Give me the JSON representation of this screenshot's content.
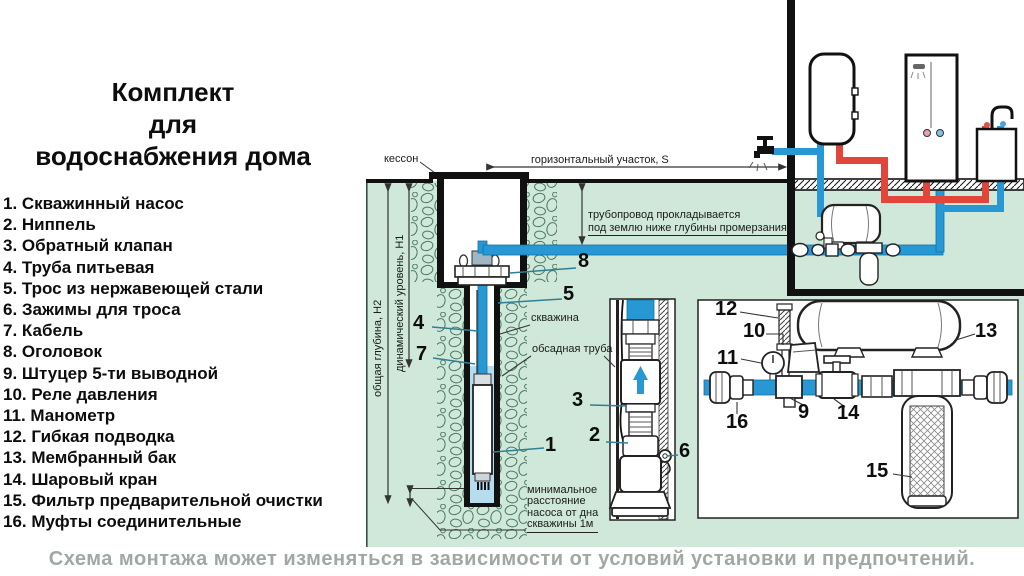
{
  "title": {
    "lines": [
      "Комплект",
      "для",
      "водоснабжения дома"
    ]
  },
  "legend": {
    "items": [
      "1. Скважинный насос",
      "2. Ниппель",
      "3. Обратный клапан",
      "4. Труба питьевая",
      "5. Трос из нержавеющей стали",
      "6. Зажимы для троса",
      "7. Кабель",
      "8. Оголовок",
      "9. Штуцер 5-ти выводной",
      "10. Реле давления",
      "11. Манометр",
      "12. Гибкая подводка",
      "13. Мембранный бак",
      "14. Шаровый кран",
      "15. Фильтр предварительной очистки",
      "16. Муфты соединительные"
    ]
  },
  "diagram": {
    "labels": {
      "kesson": "кессон",
      "horizontal_section": "горизонтальный участок, S",
      "pipeline_line1": "трубопровод прокладывается",
      "pipeline_line2": "под землю ниже глубины промерзания",
      "skvazhina": "скважина",
      "obsadnaya": "обсадная труба",
      "min_line1": "минимальное",
      "min_line2": "расстояние",
      "min_line3": "насоса от дна",
      "min_line4": "скважины 1м",
      "total_depth": "общая глубина, Н2",
      "dynamic_level": "динамический уровень, Н1"
    },
    "callouts": {
      "n1": "1",
      "n2": "2",
      "n3": "3",
      "n4": "4",
      "n5": "5",
      "n6": "6",
      "n7": "7",
      "n8": "8",
      "n9": "9",
      "n10": "10",
      "n11": "11",
      "n12": "12",
      "n13": "13",
      "n14": "14",
      "n15": "15",
      "n16": "16"
    }
  },
  "caption": "Схема монтажа может изменяться в зависимости от условий установки и предпочтений.",
  "colors": {
    "ground_green": "#cfe8da",
    "pebble_green": "#4a7a62",
    "pipe_blue": "#2898d4",
    "well_water_blue": "#b6dcf0",
    "hot_pipe_red": "#e2453a",
    "leader_teal": "#2f8096",
    "caption_gray": "#9fa9a2"
  }
}
